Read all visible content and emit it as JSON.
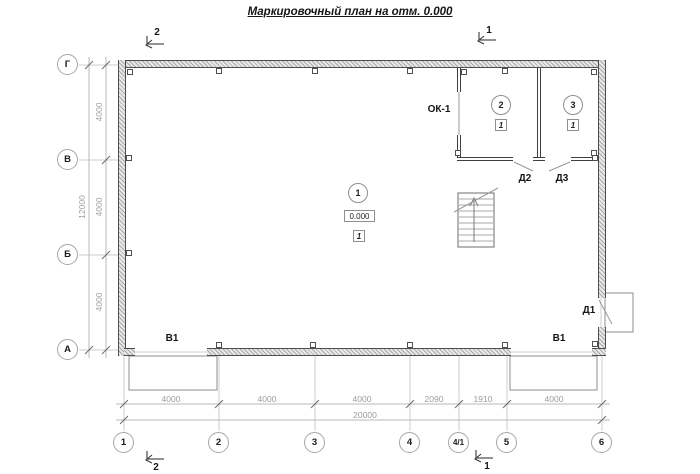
{
  "title": "Маркировочный план на отм. 0.000",
  "colors": {
    "wall_edge": "#4d4d4d",
    "wall_hatch": "#a8a8a8",
    "dimension_gray": "#9c9c9c",
    "axis_line_gray": "#c9c9c9",
    "label_black": "#161616"
  },
  "row_axes": [
    {
      "label": "Г"
    },
    {
      "label": "В"
    },
    {
      "label": "Б"
    },
    {
      "label": "А"
    }
  ],
  "col_axes": [
    {
      "label": "1"
    },
    {
      "label": "2"
    },
    {
      "label": "3"
    },
    {
      "label": "4"
    },
    {
      "label": "4/1"
    },
    {
      "label": "5"
    },
    {
      "label": "6"
    }
  ],
  "dims": {
    "left_segments": [
      "4000",
      "4000",
      "4000"
    ],
    "left_total": "12000",
    "bottom_segments": [
      "4000",
      "4000",
      "4000",
      "2090",
      "1910",
      "4000"
    ],
    "bottom_total": "20000"
  },
  "sections": {
    "top_left": "2",
    "top_right": "1",
    "bottom_left": "2",
    "bottom_right": "1"
  },
  "rooms": [
    {
      "number": "1",
      "elevation": "0.000",
      "floor_type": "1"
    },
    {
      "number": "2",
      "floor_type": "1"
    },
    {
      "number": "3",
      "floor_type": "1"
    }
  ],
  "openings": {
    "window1": "ОК-1",
    "door1": "Д1",
    "door2": "Д2",
    "door3": "Д3",
    "gate_left": "В1",
    "gate_right": "В1"
  }
}
